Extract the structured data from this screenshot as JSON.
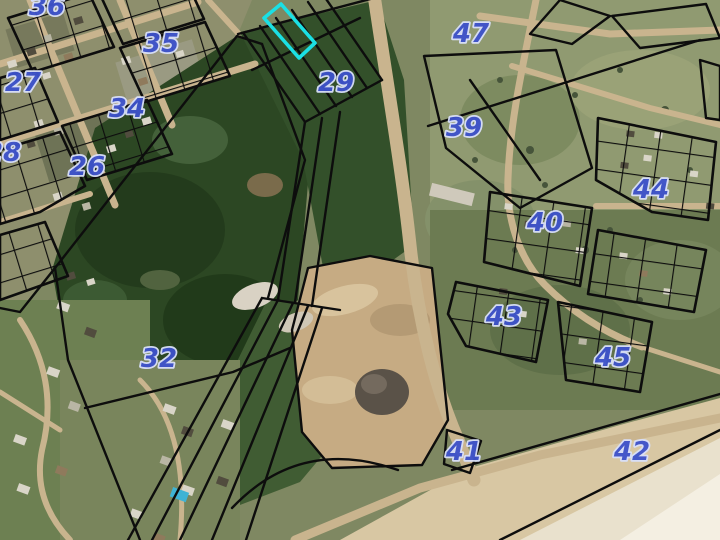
{
  "map": {
    "type": "satellite-cadastral-map",
    "selected_parcel": {
      "stroke_color": "#1be0e4",
      "points": "281,4 264,18 299,58 315,43"
    },
    "label_style": {
      "fill": "#3d52cc",
      "halo": "#d9e0fa"
    },
    "block_labels": [
      {
        "label": "36",
        "x": 47,
        "y": 15
      },
      {
        "label": "35",
        "x": 161,
        "y": 52
      },
      {
        "label": "27",
        "x": 23,
        "y": 91
      },
      {
        "label": "34",
        "x": 127,
        "y": 117
      },
      {
        "label": "28",
        "x": 3,
        "y": 161
      },
      {
        "label": "26",
        "x": 87,
        "y": 175
      },
      {
        "label": "29",
        "x": 336,
        "y": 91
      },
      {
        "label": "47",
        "x": 471,
        "y": 42
      },
      {
        "label": "39",
        "x": 464,
        "y": 136
      },
      {
        "label": "44",
        "x": 651,
        "y": 198
      },
      {
        "label": "40",
        "x": 545,
        "y": 231
      },
      {
        "label": "43",
        "x": 504,
        "y": 325
      },
      {
        "label": "45",
        "x": 613,
        "y": 366
      },
      {
        "label": "32",
        "x": 159,
        "y": 367
      },
      {
        "label": "41",
        "x": 464,
        "y": 460
      },
      {
        "label": "42",
        "x": 632,
        "y": 460
      }
    ]
  }
}
